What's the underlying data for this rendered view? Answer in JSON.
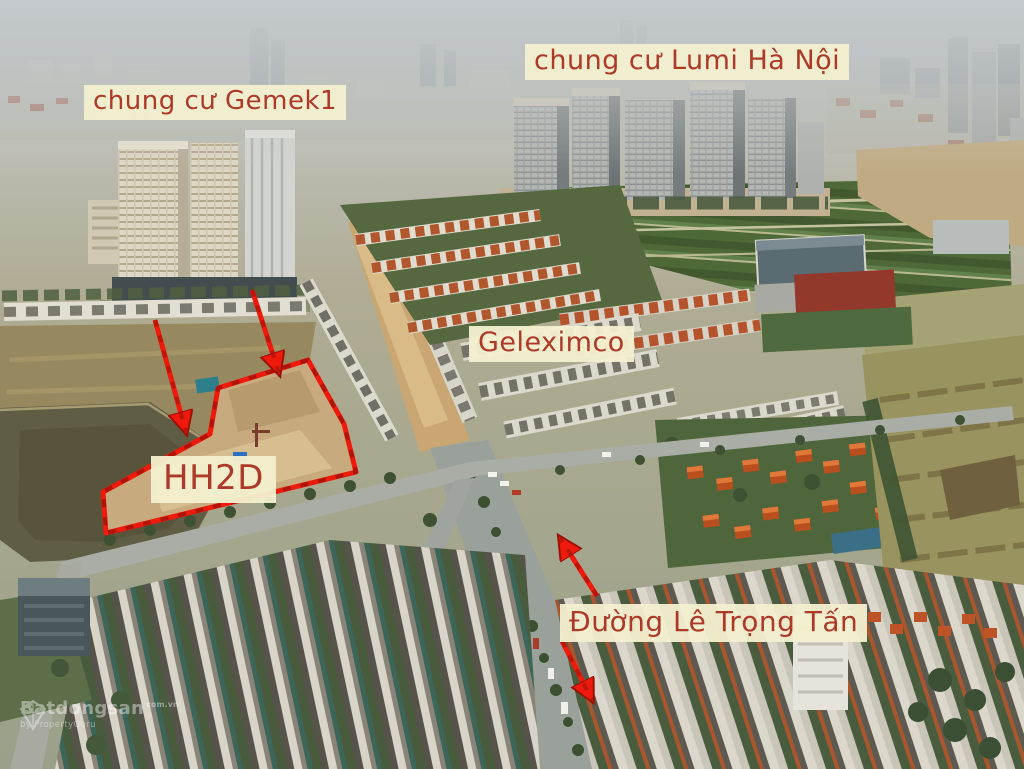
{
  "scene": {
    "description": "Aerial drone photo of the HH2D Geleximco land plot area in Hanoi with red annotation overlay",
    "labels": {
      "lumi": "chung cư Lumi Hà Nội",
      "gemek": "chung cư Gemek1",
      "geleximco": "Geleximco",
      "hh2d": "HH2D",
      "street": "Đường Lê Trọng Tấn"
    },
    "watermark": {
      "brand": "Batdongsan",
      "domain": "com.vn",
      "byline": "by PropertyGuru"
    },
    "colors": {
      "annotation_red": "#ee1a0c",
      "annotation_dark_red": "#9b1208",
      "label_background": "#f3f0d0",
      "label_text": "#ad3a28"
    }
  }
}
